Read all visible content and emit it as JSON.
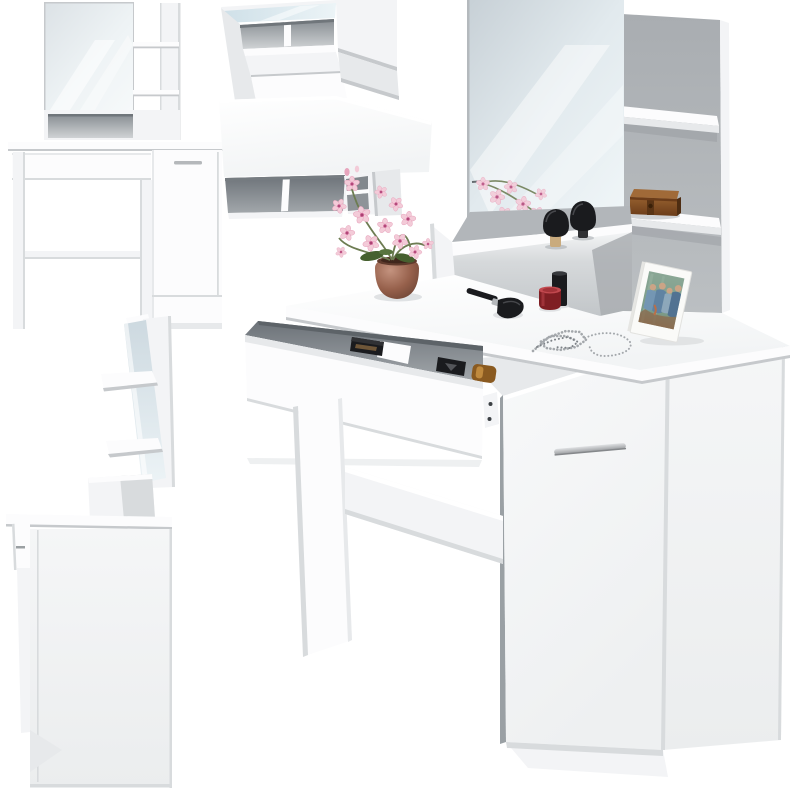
{
  "meta": {
    "description": "Product photo collage: white dressing table with mirror, shelves, open drawer and storage cabinet, shown from four angles with makeup decor",
    "canvas": {
      "width": 800,
      "height": 800
    }
  },
  "views": {
    "front": "front-elevation-view",
    "top": "top-down-view",
    "side": "side-profile-view",
    "main": "three-quarter-hero-view"
  },
  "furniture_parts": [
    "mirror",
    "wall-shelf-upper",
    "wall-shelf-lower",
    "back-panel",
    "tabletop-shelf-riser",
    "tabletop",
    "storage-drawer",
    "cabinet-door",
    "door-handle",
    "legs",
    "stretcher-rail"
  ],
  "decor_items": {
    "on_tabletop": [
      "pink-orchid-plant",
      "terracotta-flower-pot",
      "kabuki-brush-bamboo",
      "kabuki-brush-black",
      "powder-brush",
      "red-cosmetic-jar",
      "black-cosmetic-cylinder",
      "silver-chain-necklace",
      "white-photo-frame"
    ],
    "on_shelf": [
      "wooden-jewelry-box"
    ],
    "in_drawer": [
      "black-cosmetic-box",
      "black-compact",
      "amber-perfume-bottle"
    ]
  },
  "palette": {
    "bg": "#ffffff",
    "furniture_white": "#fcfcfd",
    "shade_light": "#f3f4f6",
    "shade_mid": "#e7e9eb",
    "shade_deep": "#d8dbdd",
    "edge_line": "#c6c9cc",
    "panel_gray": "#b2b6ba",
    "interior_dark": "#82888d",
    "interior_light": "#c6cacd",
    "mirror_low": "#cdd9e1",
    "mirror_high": "#eff6f8",
    "metal_silver": "#b5b8bb",
    "chain_silver": "#a4a8ac",
    "pot_brown": "#96604b",
    "pot_dark": "#5f3b2d",
    "box_brown": "#8a5428",
    "box_dark": "#52300f",
    "leaf_green": "#46602f",
    "stem_green": "#6d7c52",
    "orchid_pink": "#f3cbd8",
    "orchid_edge": "#e7a5bd",
    "orchid_deep": "#cb5e92",
    "orchid_center": "#8e2c56",
    "brush_black": "#1a1b1e",
    "bamboo": "#c9ab7e",
    "jar_red": "#7f1e23",
    "jar_red_light": "#c2494f",
    "photo_teal": "#7b9b88",
    "photo_blue": "#5d80a5",
    "photo_skin": "#d3a585"
  }
}
